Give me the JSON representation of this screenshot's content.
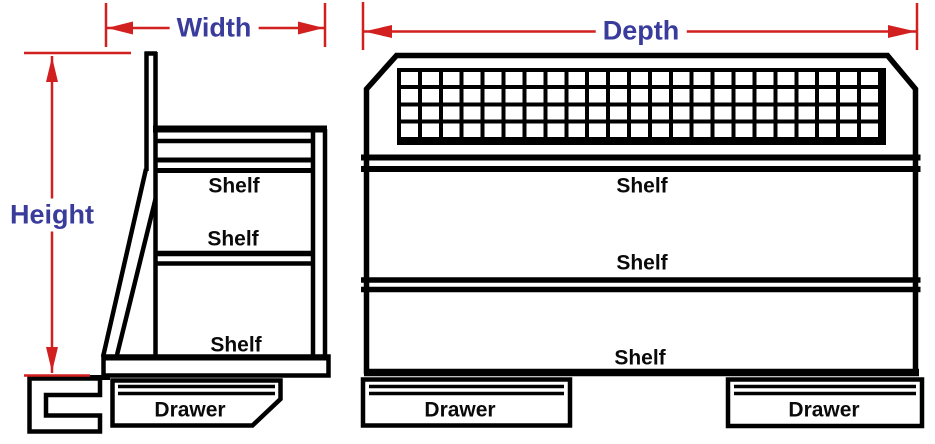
{
  "dimensions": {
    "width_label": "Width",
    "depth_label": "Depth",
    "height_label": "Height"
  },
  "side_view": {
    "shelf_labels": [
      "Shelf",
      "Shelf",
      "Shelf"
    ],
    "drawer_labels": [
      "Drawer"
    ]
  },
  "front_view": {
    "shelf_labels": [
      "Shelf",
      "Shelf",
      "Shelf"
    ],
    "drawer_labels": [
      "Drawer",
      "Drawer"
    ]
  },
  "colors": {
    "outline": "#000000",
    "dimension_line": "#d21f1f",
    "dimension_text": "#3a3c9c",
    "background": "#ffffff"
  }
}
